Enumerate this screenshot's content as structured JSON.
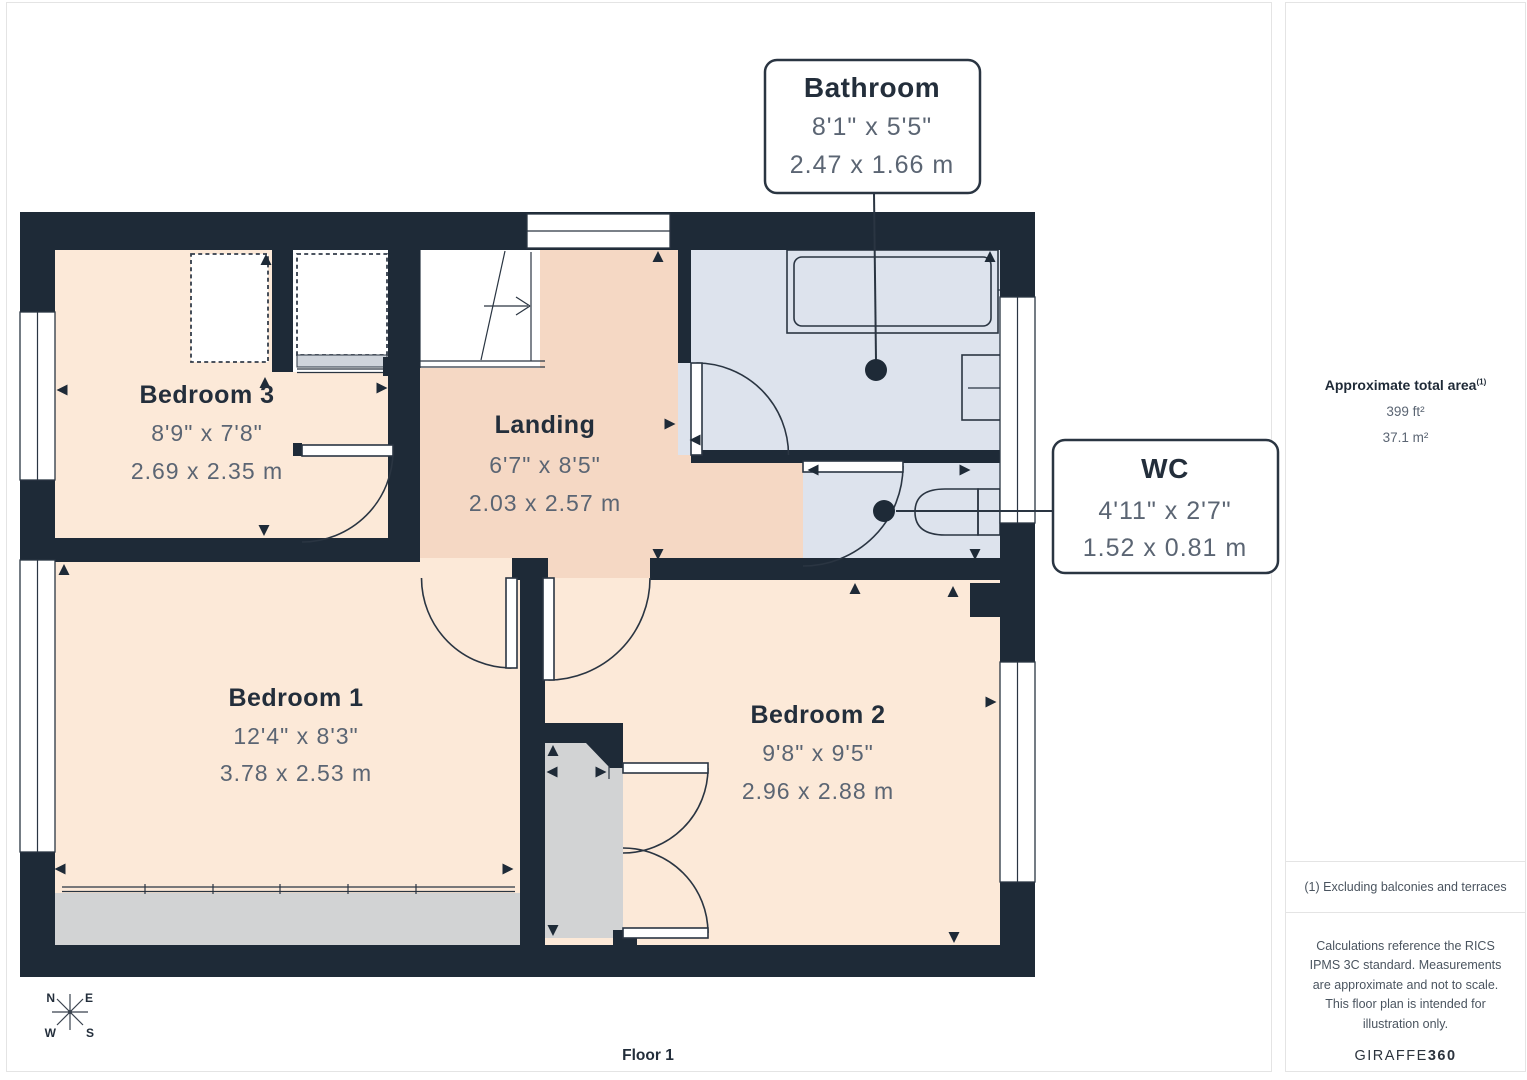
{
  "plan": {
    "floor_label": "Floor 1",
    "compass": {
      "n": "N",
      "e": "E",
      "s": "S",
      "w": "W"
    },
    "rooms": [
      {
        "name": "Bedroom 3",
        "imperial": "8'9\" x 7'8\"",
        "metric": "2.69 x 2.35 m"
      },
      {
        "name": "Landing",
        "imperial": "6'7\" x 8'5\"",
        "metric": "2.03 x 2.57 m"
      },
      {
        "name": "Bedroom 1",
        "imperial": "12'4\" x 8'3\"",
        "metric": "3.78 x 2.53 m"
      },
      {
        "name": "Bedroom 2",
        "imperial": "9'8\" x 9'5\"",
        "metric": "2.96 x 2.88 m"
      }
    ],
    "callouts": [
      {
        "name": "Bathroom",
        "imperial": "8'1\" x 5'5\"",
        "metric": "2.47 x 1.66 m"
      },
      {
        "name": "WC",
        "imperial": "4'11\" x 2'7\"",
        "metric": "1.52 x 0.81 m"
      }
    ],
    "colors": {
      "wall": "#1e2a37",
      "bedroom_floor": "#fce9d8",
      "landing_floor": "#f5d8c4",
      "bathroom_floor": "#dde3ed",
      "closet_floor": "#d2d3d4",
      "label_text": "#232e3b",
      "dimension_text": "#5b6573"
    }
  },
  "sidebar": {
    "area_title": "Approximate total area",
    "area_footnote_marker": "(1)",
    "area_imperial": "399 ft²",
    "area_metric": "37.1 m²",
    "footnote": "(1) Excluding balconies and terraces",
    "disclaimer": "Calculations reference the RICS IPMS 3C standard. Measurements are approximate and not to scale. This floor plan is intended for illustration only.",
    "brand_name": "GIRAFFE",
    "brand_suffix": "360"
  }
}
